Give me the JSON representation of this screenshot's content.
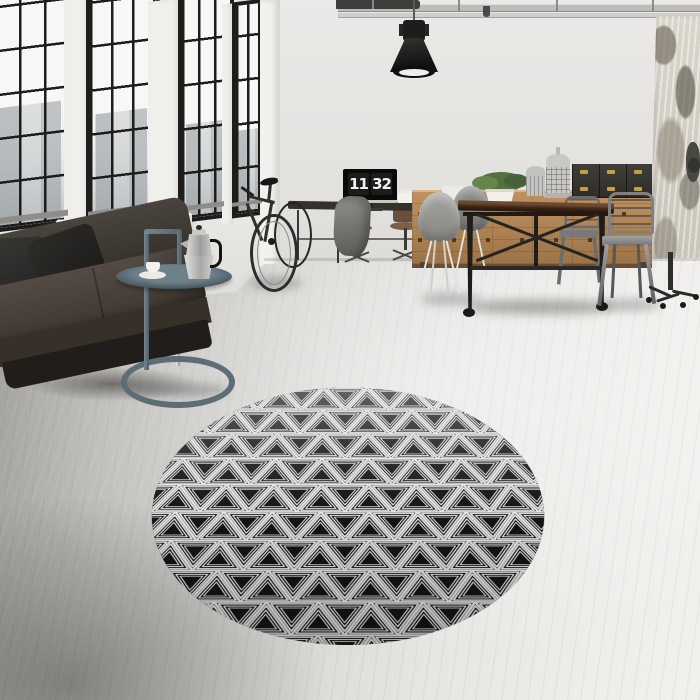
{
  "clock": {
    "hours": "11",
    "minutes": "32"
  },
  "palette": {
    "wall": "#e5e3e0",
    "frame": "#1d1d1b",
    "glass": "#f7f7f5",
    "digit-white": "#f2f2f2",
    "wood-light": "#c09160",
    "wood-dark": "#9c7447",
    "table-top": "#3b2415",
    "plant-green": "#54703e",
    "pot-white": "#f0efec",
    "brass": "#c59e3e",
    "rug-black": "#141414",
    "rug-white": "#e3e3e3"
  }
}
